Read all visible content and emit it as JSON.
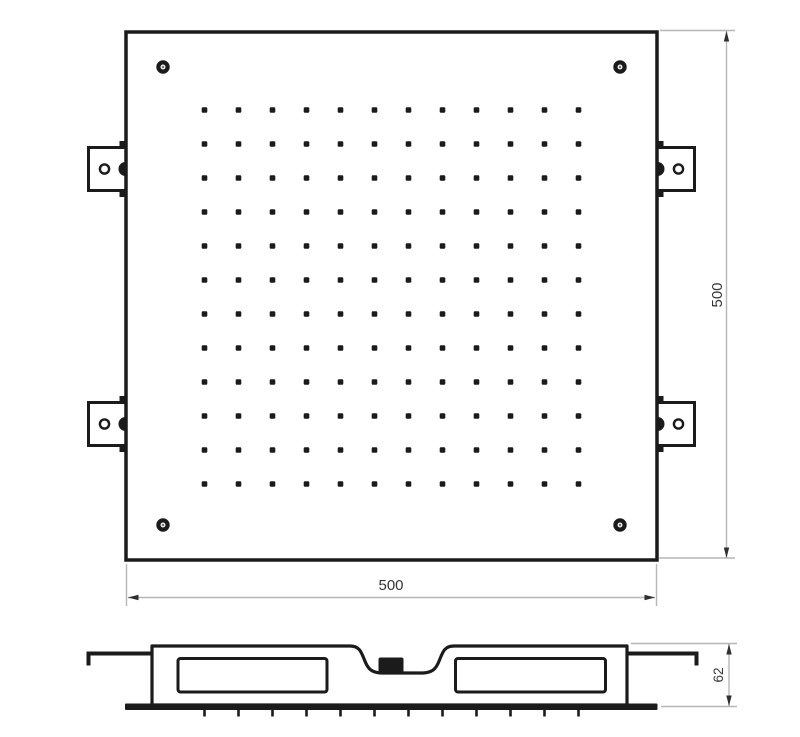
{
  "colors": {
    "line": "#1b1b1b",
    "dim_line": "#b6b6b6",
    "dim_text": "#353535",
    "arrow": "#2f2f2f",
    "background": "#ffffff"
  },
  "top_view": {
    "width_label": "500",
    "height_label": "500",
    "nozzle_grid": {
      "rows": 12,
      "cols": 12
    },
    "corner_screw_count": 4,
    "mounting_bracket_count": 4
  },
  "side_view": {
    "depth_label": "62",
    "nozzle_tick_count": 12
  }
}
